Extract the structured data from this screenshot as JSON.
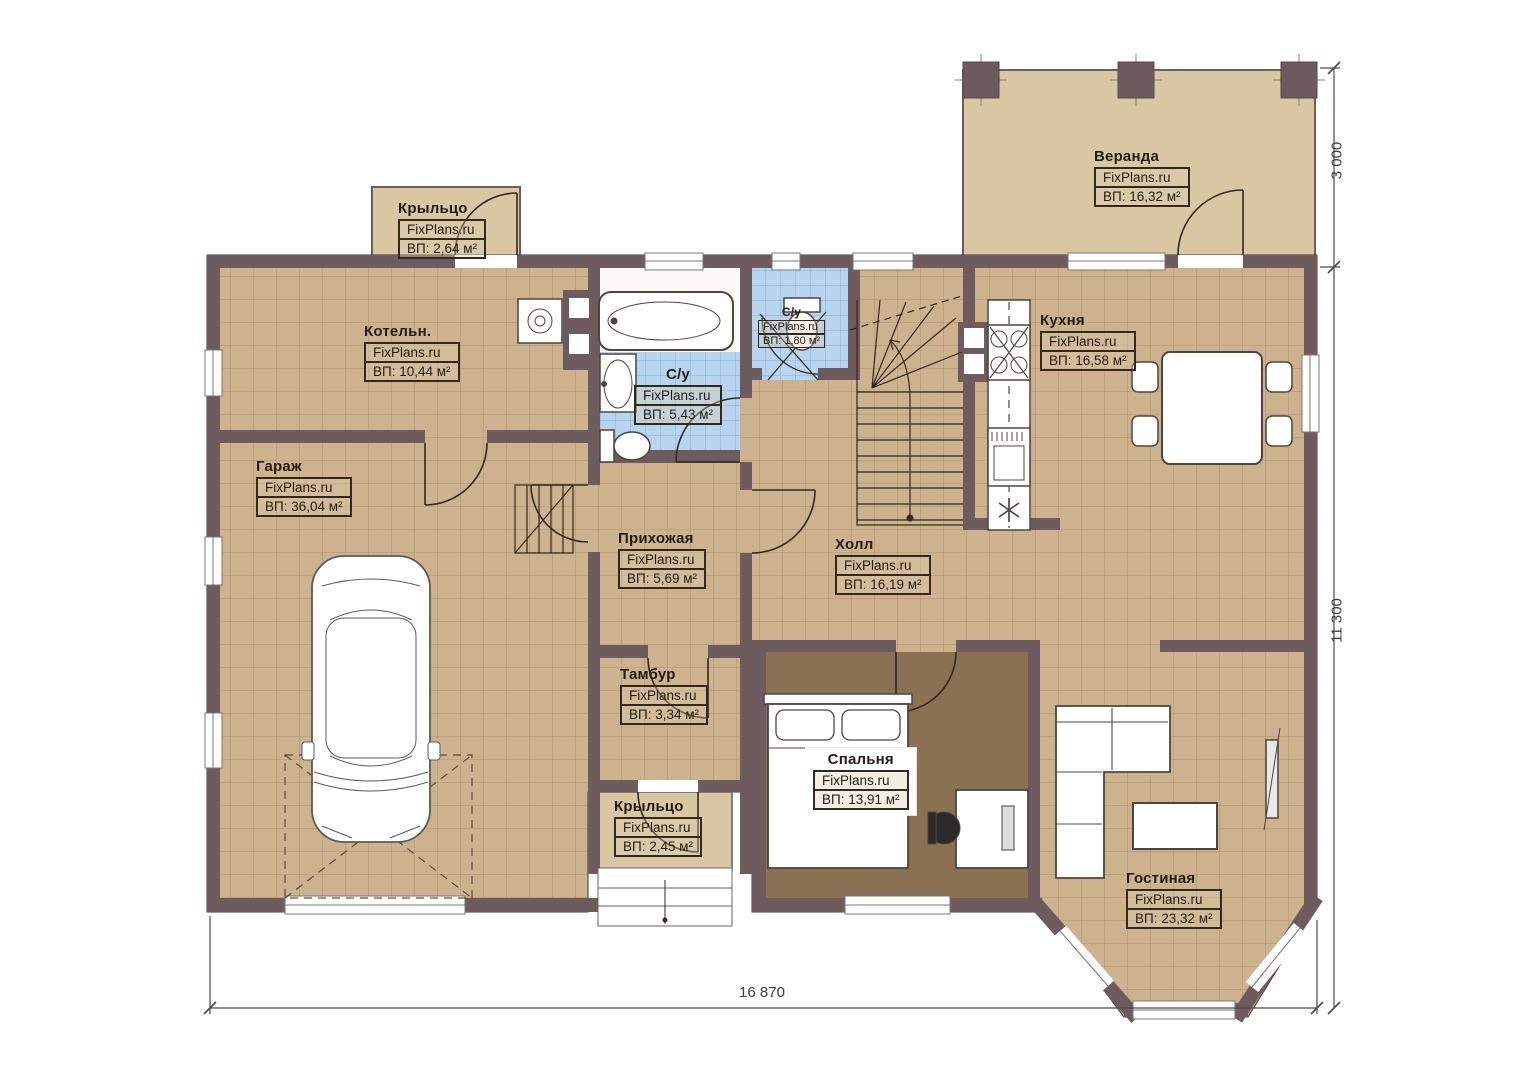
{
  "plan": {
    "brand": "FixPlans.ru",
    "dimensions": {
      "width_label": "16 870",
      "depth_label": "11 300",
      "veranda_depth_label": "3 000"
    },
    "colors": {
      "wall": "#6e5b5e",
      "floor_tile": "#cdb28e",
      "wet_tile": "#b7d5ee",
      "bedroom_floor": "#8b7153",
      "veranda_floor": "#d9c7a4"
    },
    "rooms": {
      "veranda": {
        "name": "Веранда",
        "brand": "FixPlans.ru",
        "area": "ВП: 16,32 м²"
      },
      "porch_top": {
        "name": "Крыльцо",
        "brand": "FixPlans.ru",
        "area": "ВП: 2,64 м²"
      },
      "boiler": {
        "name": "Котельн.",
        "brand": "FixPlans.ru",
        "area": "ВП: 10,44 м²"
      },
      "garage": {
        "name": "Гараж",
        "brand": "FixPlans.ru",
        "area": "ВП: 36,04 м²"
      },
      "bathroom": {
        "name": "С/у",
        "brand": "FixPlans.ru",
        "area": "ВП: 5,43 м²"
      },
      "wc": {
        "name": "С/у",
        "brand": "FixPlans.ru",
        "area": "ВП: 1,80 м²"
      },
      "kitchen": {
        "name": "Кухня",
        "brand": "FixPlans.ru",
        "area": "ВП: 16,58 м²"
      },
      "hallway": {
        "name": "Прихожая",
        "brand": "FixPlans.ru",
        "area": "ВП: 5,69 м²"
      },
      "hall": {
        "name": "Холл",
        "brand": "FixPlans.ru",
        "area": "ВП: 16,19 м²"
      },
      "vestibule": {
        "name": "Тамбур",
        "brand": "FixPlans.ru",
        "area": "ВП: 3,34 м²"
      },
      "porch_bottom": {
        "name": "Крыльцо",
        "brand": "FixPlans.ru",
        "area": "ВП: 2,45 м²"
      },
      "bedroom": {
        "name": "Спальня",
        "brand": "FixPlans.ru",
        "area": "ВП: 13,91 м²"
      },
      "living": {
        "name": "Гостиная",
        "brand": "FixPlans.ru",
        "area": "ВП: 23,32 м²"
      }
    }
  }
}
